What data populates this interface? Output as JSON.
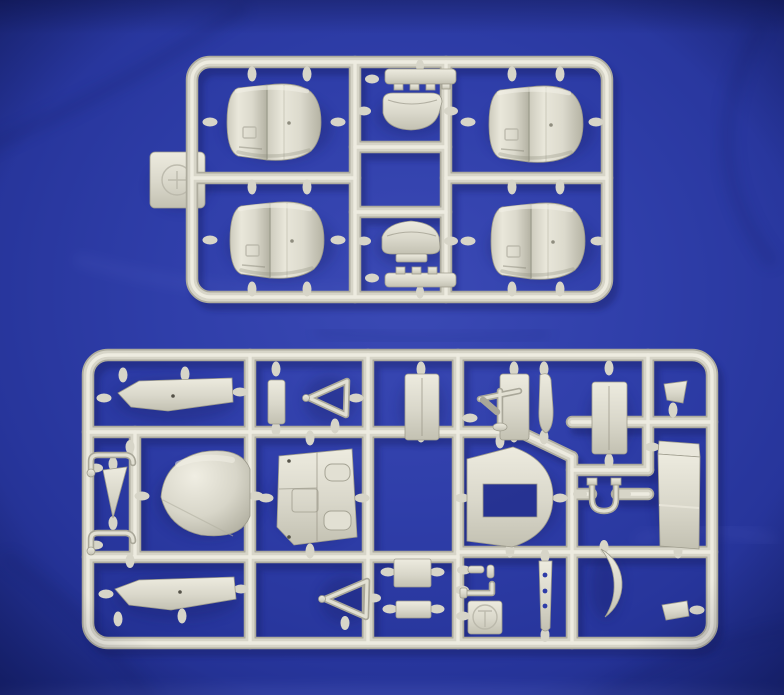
{
  "scene": {
    "type": "photograph",
    "subject": "Two light-grey injection-moulded model kit sprues photographed on creased royal-blue cloth",
    "text_visible": "none",
    "sprue_count": 2
  },
  "colors": {
    "cloth_blue": "#2e3ca8",
    "cloth_blue_light": "#4353bd",
    "cloth_blue_dark": "#1b2880",
    "plastic_light": "#efede2",
    "plastic_mid": "#d7d5c8",
    "plastic_dark": "#aeac9e",
    "cast_shadow": "#131d63"
  },
  "top_sprue": {
    "name": "engine cowling sprue",
    "layout": "rounded rectangular frame, three columns",
    "parts": [
      {
        "id": "engine-cowling",
        "label": "radial engine cowling",
        "count": 4
      },
      {
        "id": "intake-slat",
        "label": "slotted intake strip",
        "count": 2
      },
      {
        "id": "intake-scoop",
        "label": "carburettor intake scoop",
        "count": 2
      },
      {
        "id": "maker-tab",
        "label": "square tab with embossed logo",
        "count": 1
      }
    ]
  },
  "bottom_sprue": {
    "name": "airframe detail sprue",
    "layout": "rounded rectangular frame, dense grid of runners",
    "parts": [
      {
        "id": "float-half",
        "label": "long tapered float half",
        "count": 2
      },
      {
        "id": "nose-cone",
        "label": "conical nose fairing",
        "count": 1
      },
      {
        "id": "cockpit-side-panel",
        "label": "panelled cockpit sidewall",
        "count": 1
      },
      {
        "id": "bulkhead-window",
        "label": "D-shaped bulkhead with rectangular opening",
        "count": 1
      },
      {
        "id": "strut-triangle",
        "label": "triangular strut frame",
        "count": 2
      },
      {
        "id": "rect-panel",
        "label": "small rectangular panel",
        "count": 5
      },
      {
        "id": "mast",
        "label": "small mast with cross-arm",
        "count": 1
      },
      {
        "id": "tapered-strut",
        "label": "tapered strut",
        "count": 1
      },
      {
        "id": "horseshoe-bracket",
        "label": "U-shaped bracket",
        "count": 1
      },
      {
        "id": "box-fairing",
        "label": "long rectangular box fairing",
        "count": 1
      },
      {
        "id": "crank-lever",
        "label": "cranked lever",
        "count": 2
      },
      {
        "id": "small-fin",
        "label": "small triangular fin",
        "count": 1
      },
      {
        "id": "elbow-pipe",
        "label": "L-shaped pipe",
        "count": 1
      },
      {
        "id": "small-rods",
        "label": "small rod pieces",
        "count": 2
      },
      {
        "id": "drilled-strut",
        "label": "strut with three lightening holes",
        "count": 1
      },
      {
        "id": "bow-skid",
        "label": "curved bow skid",
        "count": 1
      },
      {
        "id": "small-wedge",
        "label": "small wedge block",
        "count": 2
      },
      {
        "id": "maker-tab",
        "label": "square tab with embossed logo",
        "count": 1
      }
    ]
  }
}
